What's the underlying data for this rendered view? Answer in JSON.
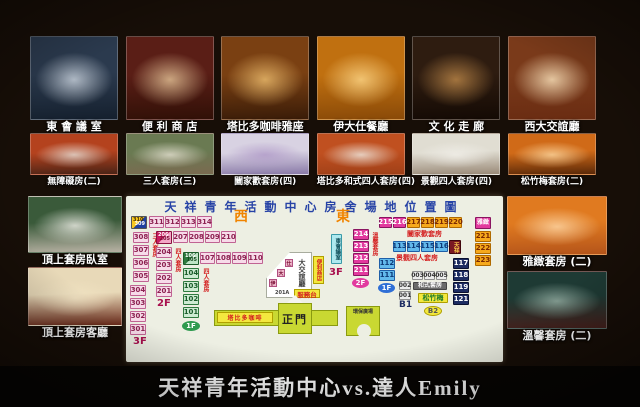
{
  "page": {
    "caption": "天祥青年活動中心vs.達人Emily"
  },
  "board": {
    "top_photos": [
      {
        "name": "east-conference-room",
        "label": "東 會 議 室",
        "tones": [
          "#2b3a4e",
          "#cfd8e2",
          "#15202e"
        ]
      },
      {
        "name": "convenience-store",
        "label": "便 利 商 店",
        "tones": [
          "#5a1e16",
          "#e8c79a",
          "#311007"
        ]
      },
      {
        "name": "tabido-coffee",
        "label": "塔比多咖啡雅座",
        "tones": [
          "#7a4012",
          "#f0c070",
          "#3a1c08"
        ]
      },
      {
        "name": "idas-restaurant",
        "label": "伊大仕餐廳",
        "tones": [
          "#c07010",
          "#ffd98a",
          "#8a4a08"
        ]
      },
      {
        "name": "culture-corridor",
        "label": "文 化 走 廊",
        "tones": [
          "#2e1c10",
          "#c08a4a",
          "#140a04"
        ]
      },
      {
        "name": "west-lounge",
        "label": "西大交誼廳",
        "tones": [
          "#7a3a1a",
          "#ffe8c0",
          "#6a2c12"
        ]
      }
    ],
    "mid_photos": [
      {
        "name": "accessible-room",
        "label": "無障礙房(二)",
        "tones": [
          "#b4421e",
          "#e8e2da",
          "#4a2316"
        ]
      },
      {
        "name": "triple-suite",
        "label": "三人套房(三)",
        "tones": [
          "#6a7a52",
          "#e6e2d2",
          "#7a6a50"
        ]
      },
      {
        "name": "family-suite",
        "label": "闔家歡套房(四)",
        "tones": [
          "#d8d2e2",
          "#b09ac8",
          "#8a7aa8"
        ]
      },
      {
        "name": "tabido-japanese-suite",
        "label": "塔比多和式四人套房(四)",
        "tones": [
          "#c05020",
          "#f0ece4",
          "#a04018"
        ]
      },
      {
        "name": "scenic-quad-suite",
        "label": "景觀四人套房(四)",
        "tones": [
          "#e0ddd2",
          "#f2f0ea",
          "#9a8a78"
        ]
      },
      {
        "name": "pine-bamboo-plum-suite",
        "label": "松竹梅套房(二)",
        "tones": [
          "#d06a18",
          "#ffd9a0",
          "#5a2808"
        ]
      }
    ],
    "left_photos": [
      {
        "name": "top-suite-bedroom",
        "label": "頂上套房臥室",
        "tones": [
          "#3a5a3a",
          "#f0efe8",
          "#b8b2a4"
        ]
      },
      {
        "name": "top-suite-livingroom",
        "label": "頂上套房客廳",
        "tones": [
          "#e8d9b8",
          "#f2e4c4",
          "#6a2a1a"
        ]
      }
    ],
    "right_photos": [
      {
        "name": "elegant-suite",
        "label": "雅緻套房 (二)",
        "tones": [
          "#e07a20",
          "#ffd9a8",
          "#b4541a"
        ]
      },
      {
        "name": "cozy-suite",
        "label": "溫馨套房 (二)",
        "tones": [
          "#1e3a34",
          "#9ab4a8",
          "#46201c"
        ]
      }
    ],
    "map": {
      "title": "天祥青年活動中心房舍場地位置圖",
      "compass": {
        "west": "西",
        "east": "東"
      },
      "lobby": "大交誼廳",
      "lobby_chips": [
        "伊",
        "大",
        "仕"
      ],
      "store": "便利商店",
      "desk": "服務台",
      "ramp": "201A",
      "gate": "正門",
      "cafe": "塔比多咖啡",
      "plaza": "環保廣場",
      "colors": {
        "pink": "#f7dbe9",
        "magenta": "#e23a9e",
        "orange": "#f6a91c",
        "blue": "#62b9ec",
        "navy": "#1d2c62",
        "green": "#cdebd2",
        "yellow": "#f3e83e",
        "title_blue": "#2743a6",
        "compass_orange": "#f08400",
        "label_red": "#d42020"
      },
      "elements": [
        {
          "k": "diag",
          "c": "d-yb",
          "a": "310",
          "b": "309",
          "x": 5,
          "y": 20,
          "w": 16,
          "h": 13
        },
        {
          "k": "box",
          "c": "pink",
          "t": "311",
          "x": 23,
          "y": 20,
          "w": 15,
          "h": 12
        },
        {
          "k": "box",
          "c": "pink",
          "t": "312",
          "x": 39,
          "y": 20,
          "w": 15,
          "h": 12
        },
        {
          "k": "box",
          "c": "pink",
          "t": "313",
          "x": 55,
          "y": 20,
          "w": 15,
          "h": 12
        },
        {
          "k": "box",
          "c": "pink",
          "t": "314",
          "x": 71,
          "y": 20,
          "w": 15,
          "h": 12
        },
        {
          "k": "text",
          "c": "t-orange",
          "t": "西",
          "x": 108,
          "y": 14,
          "f": 14
        },
        {
          "k": "text",
          "c": "t-orange",
          "t": "東",
          "x": 210,
          "y": 14,
          "f": 14
        },
        {
          "k": "box",
          "c": "pink",
          "t": "308",
          "x": 7,
          "y": 36,
          "w": 16,
          "h": 11
        },
        {
          "k": "box",
          "c": "pink",
          "t": "307",
          "x": 7,
          "y": 49,
          "w": 16,
          "h": 11
        },
        {
          "k": "box",
          "c": "pink",
          "t": "306",
          "x": 7,
          "y": 62,
          "w": 16,
          "h": 11
        },
        {
          "k": "box",
          "c": "pink",
          "t": "305",
          "x": 7,
          "y": 75,
          "w": 16,
          "h": 11
        },
        {
          "k": "vtext",
          "t": "三人套房",
          "x": 25,
          "y": 37,
          "h": 50
        },
        {
          "k": "box",
          "c": "pink",
          "t": "304",
          "x": 4,
          "y": 89,
          "w": 16,
          "h": 11
        },
        {
          "k": "box",
          "c": "pink",
          "t": "303",
          "x": 4,
          "y": 102,
          "w": 16,
          "h": 11
        },
        {
          "k": "box",
          "c": "pink",
          "t": "302",
          "x": 4,
          "y": 115,
          "w": 16,
          "h": 11
        },
        {
          "k": "box",
          "c": "pink",
          "t": "301",
          "x": 4,
          "y": 128,
          "w": 16,
          "h": 11
        },
        {
          "k": "text",
          "c": "t-maroon",
          "t": "3F",
          "x": 7,
          "y": 141,
          "f": 10
        },
        {
          "k": "diag",
          "c": "d-cr",
          "a": "206",
          "b": "205",
          "x": 30,
          "y": 35,
          "w": 16,
          "h": 13
        },
        {
          "k": "box",
          "c": "pink",
          "t": "207",
          "x": 47,
          "y": 35,
          "w": 15,
          "h": 12
        },
        {
          "k": "box",
          "c": "pink",
          "t": "208",
          "x": 63,
          "y": 35,
          "w": 15,
          "h": 12
        },
        {
          "k": "box",
          "c": "pink",
          "t": "209",
          "x": 79,
          "y": 35,
          "w": 15,
          "h": 12
        },
        {
          "k": "box",
          "c": "pink",
          "t": "210",
          "x": 95,
          "y": 35,
          "w": 15,
          "h": 12
        },
        {
          "k": "box",
          "c": "pink",
          "t": "204",
          "x": 30,
          "y": 51,
          "w": 16,
          "h": 11
        },
        {
          "k": "box",
          "c": "pink",
          "t": "203",
          "x": 30,
          "y": 64,
          "w": 16,
          "h": 11
        },
        {
          "k": "box",
          "c": "pink",
          "t": "202",
          "x": 30,
          "y": 77,
          "w": 16,
          "h": 11
        },
        {
          "k": "box",
          "c": "pink",
          "t": "201",
          "x": 30,
          "y": 90,
          "w": 16,
          "h": 11
        },
        {
          "k": "vtext",
          "t": "四人套房",
          "x": 48,
          "y": 52,
          "h": 44
        },
        {
          "k": "text",
          "c": "t-maroon",
          "t": "2F",
          "x": 31,
          "y": 103,
          "f": 10
        },
        {
          "k": "diag",
          "c": "d-gr",
          "a": "106",
          "b": "105",
          "x": 57,
          "y": 56,
          "w": 16,
          "h": 13
        },
        {
          "k": "box",
          "c": "pink",
          "t": "107",
          "x": 74,
          "y": 56,
          "w": 15,
          "h": 12
        },
        {
          "k": "box",
          "c": "pink",
          "t": "108",
          "x": 90,
          "y": 56,
          "w": 15,
          "h": 12
        },
        {
          "k": "box",
          "c": "pink",
          "t": "109",
          "x": 106,
          "y": 56,
          "w": 15,
          "h": 12
        },
        {
          "k": "box",
          "c": "pink",
          "t": "110",
          "x": 122,
          "y": 56,
          "w": 15,
          "h": 12
        },
        {
          "k": "box",
          "c": "green",
          "t": "104",
          "x": 57,
          "y": 72,
          "w": 16,
          "h": 11
        },
        {
          "k": "box",
          "c": "green",
          "t": "103",
          "x": 57,
          "y": 85,
          "w": 16,
          "h": 11
        },
        {
          "k": "box",
          "c": "green",
          "t": "102",
          "x": 57,
          "y": 98,
          "w": 16,
          "h": 11
        },
        {
          "k": "box",
          "c": "green",
          "t": "101",
          "x": 57,
          "y": 111,
          "w": 16,
          "h": 11
        },
        {
          "k": "vtext",
          "t": "四人套房",
          "x": 76,
          "y": 72,
          "h": 44
        },
        {
          "k": "oval",
          "c": "o-green",
          "t": "1F",
          "x": 56,
          "y": 125,
          "w": 18,
          "h": 10
        },
        {
          "k": "vbox",
          "c": "cyan",
          "t": "東會議室",
          "x": 205,
          "y": 38,
          "w": 11,
          "h": 30
        },
        {
          "k": "text",
          "c": "t-maroon",
          "t": "3F",
          "x": 203,
          "y": 72,
          "f": 10
        },
        {
          "k": "box",
          "c": "magenta",
          "t": "214",
          "x": 227,
          "y": 33,
          "w": 16,
          "h": 11
        },
        {
          "k": "box",
          "c": "magenta",
          "t": "213",
          "x": 227,
          "y": 45,
          "w": 16,
          "h": 11
        },
        {
          "k": "box",
          "c": "magenta",
          "t": "212",
          "x": 227,
          "y": 57,
          "w": 16,
          "h": 11
        },
        {
          "k": "box",
          "c": "magenta",
          "t": "211",
          "x": 227,
          "y": 69,
          "w": 16,
          "h": 11
        },
        {
          "k": "oval",
          "c": "o-magenta",
          "t": "2F",
          "x": 226,
          "y": 82,
          "w": 17,
          "h": 10
        },
        {
          "k": "vtext",
          "t": "溫馨套房",
          "x": 245,
          "y": 36,
          "h": 36
        },
        {
          "k": "box",
          "c": "blue",
          "t": "112",
          "x": 253,
          "y": 62,
          "w": 16,
          "h": 11
        },
        {
          "k": "box",
          "c": "blue",
          "t": "111",
          "x": 253,
          "y": 74,
          "w": 16,
          "h": 11
        },
        {
          "k": "oval",
          "c": "o-blue",
          "t": "1F",
          "x": 252,
          "y": 87,
          "w": 17,
          "h": 10
        },
        {
          "k": "box",
          "c": "magenta",
          "t": "215",
          "x": 253,
          "y": 21,
          "w": 13,
          "h": 11
        },
        {
          "k": "box",
          "c": "magenta",
          "t": "216",
          "x": 267,
          "y": 21,
          "w": 13,
          "h": 11
        },
        {
          "k": "box",
          "c": "orange",
          "t": "217",
          "x": 281,
          "y": 21,
          "w": 13,
          "h": 11
        },
        {
          "k": "box",
          "c": "orange",
          "t": "218",
          "x": 295,
          "y": 21,
          "w": 13,
          "h": 11
        },
        {
          "k": "box",
          "c": "orange",
          "t": "219",
          "x": 309,
          "y": 21,
          "w": 13,
          "h": 11
        },
        {
          "k": "box",
          "c": "orange",
          "t": "220",
          "x": 323,
          "y": 21,
          "w": 13,
          "h": 11
        },
        {
          "k": "text",
          "c": "t-red",
          "t": "闔家歡套房",
          "x": 281,
          "y": 35,
          "f": 7
        },
        {
          "k": "box",
          "c": "blue",
          "t": "113",
          "x": 267,
          "y": 45,
          "w": 13,
          "h": 11
        },
        {
          "k": "box",
          "c": "blue",
          "t": "114",
          "x": 281,
          "y": 45,
          "w": 13,
          "h": 11
        },
        {
          "k": "box",
          "c": "blue",
          "t": "115",
          "x": 295,
          "y": 45,
          "w": 13,
          "h": 11
        },
        {
          "k": "box",
          "c": "blue",
          "t": "116",
          "x": 309,
          "y": 45,
          "w": 13,
          "h": 11
        },
        {
          "k": "vbox",
          "c": "darkred",
          "t": "天祥",
          "x": 323,
          "y": 44,
          "w": 12,
          "h": 14
        },
        {
          "k": "text",
          "c": "t-red",
          "t": "景觀四人套房",
          "x": 270,
          "y": 59,
          "f": 7
        },
        {
          "k": "box",
          "c": "navy",
          "t": "117",
          "x": 327,
          "y": 62,
          "w": 16,
          "h": 11
        },
        {
          "k": "box",
          "c": "navy",
          "t": "118",
          "x": 327,
          "y": 74,
          "w": 16,
          "h": 11
        },
        {
          "k": "box",
          "c": "navy",
          "t": "119",
          "x": 327,
          "y": 86,
          "w": 16,
          "h": 11
        },
        {
          "k": "box",
          "c": "navy",
          "t": "121",
          "x": 327,
          "y": 98,
          "w": 16,
          "h": 11
        },
        {
          "k": "box",
          "c": "grey",
          "t": "003",
          "x": 286,
          "y": 75,
          "w": 11,
          "h": 9,
          "f": 6
        },
        {
          "k": "box",
          "c": "grey",
          "t": "004",
          "x": 298,
          "y": 75,
          "w": 11,
          "h": 9,
          "f": 6
        },
        {
          "k": "box",
          "c": "grey",
          "t": "005",
          "x": 310,
          "y": 75,
          "w": 11,
          "h": 9,
          "f": 6
        },
        {
          "k": "box",
          "c": "grey",
          "t": "002",
          "x": 273,
          "y": 85,
          "w": 12,
          "h": 9,
          "f": 6
        },
        {
          "k": "box",
          "c": "grey",
          "t": "001",
          "x": 273,
          "y": 95,
          "w": 12,
          "h": 9,
          "f": 6
        },
        {
          "k": "box",
          "c": "dim",
          "t": "和式套房",
          "x": 287,
          "y": 86,
          "w": 34,
          "h": 8,
          "f": 6
        },
        {
          "k": "text",
          "c": "t-navy",
          "t": "B1",
          "x": 273,
          "y": 105,
          "f": 9
        },
        {
          "k": "box",
          "c": "yellowg",
          "t": "松竹梅",
          "x": 292,
          "y": 97,
          "w": 30,
          "h": 10,
          "f": 7
        },
        {
          "k": "oval",
          "c": "o-yellow",
          "t": "B2",
          "x": 298,
          "y": 110,
          "w": 18,
          "h": 10
        },
        {
          "k": "box",
          "c": "magenta",
          "t": "雅緻",
          "x": 349,
          "y": 21,
          "w": 16,
          "h": 12,
          "f": 6
        },
        {
          "k": "box",
          "c": "orange",
          "t": "221",
          "x": 349,
          "y": 35,
          "w": 16,
          "h": 11
        },
        {
          "k": "box",
          "c": "orange",
          "t": "222",
          "x": 349,
          "y": 47,
          "w": 16,
          "h": 11
        },
        {
          "k": "box",
          "c": "orange",
          "t": "223",
          "x": 349,
          "y": 59,
          "w": 16,
          "h": 11
        }
      ]
    }
  }
}
